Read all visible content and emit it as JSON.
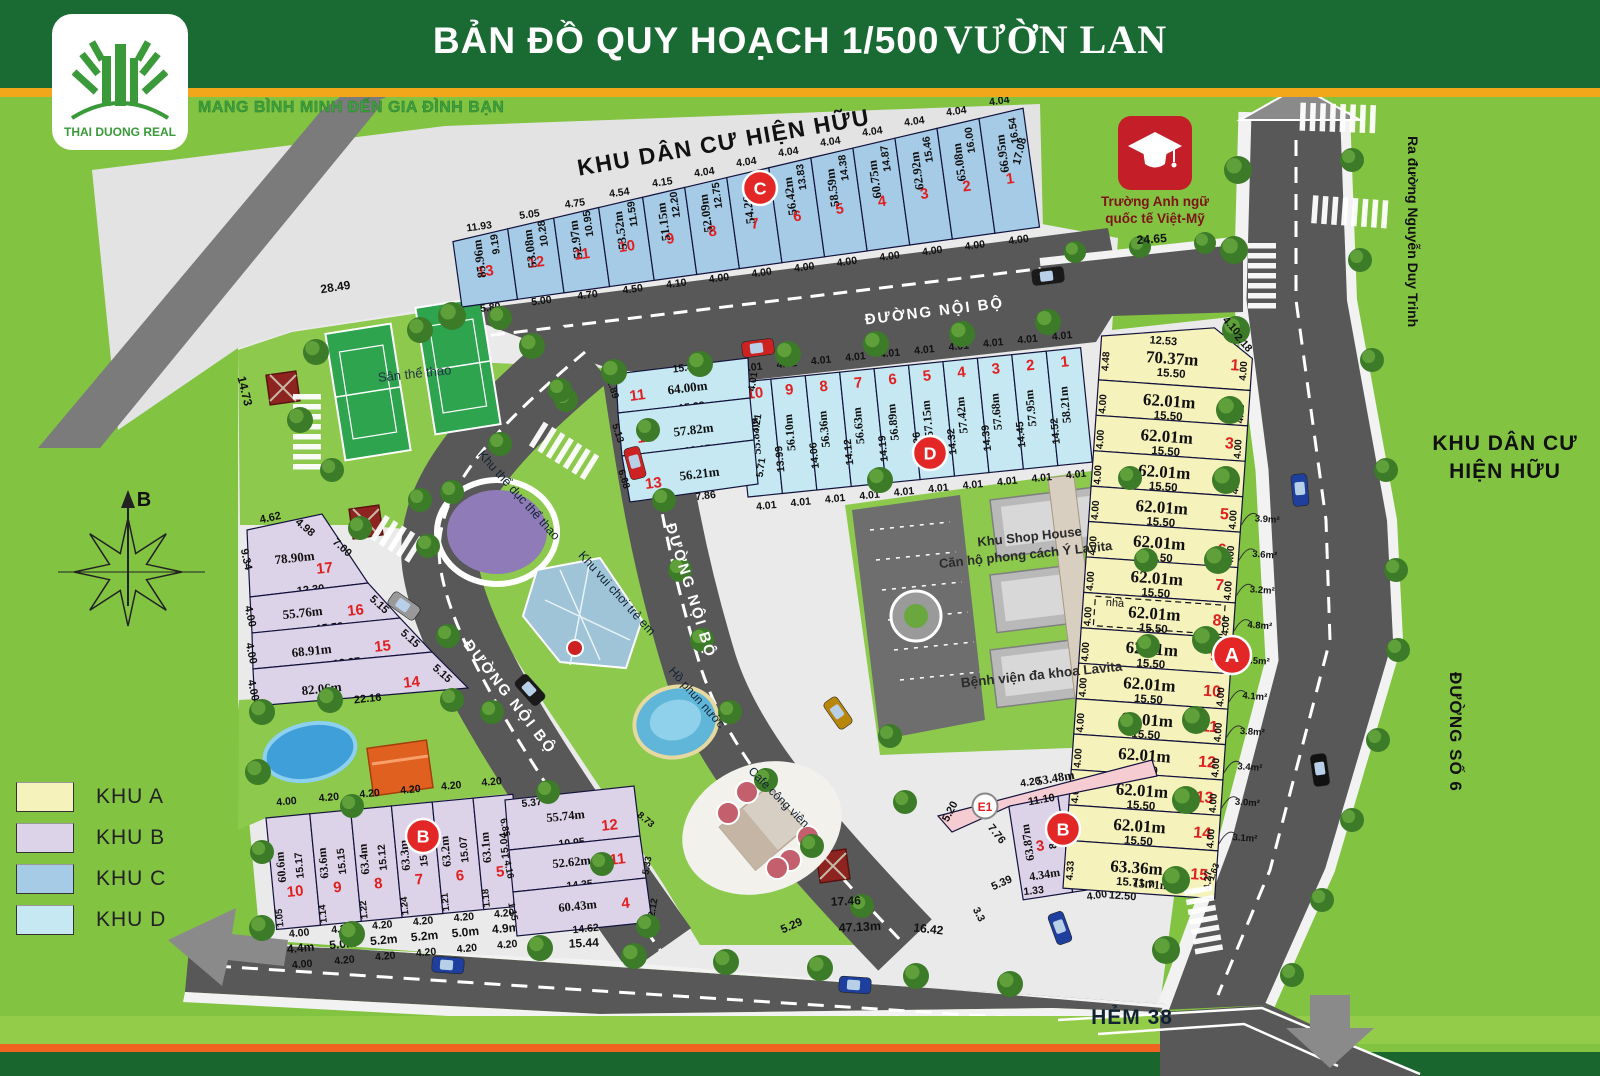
{
  "header": {
    "title_main": "BẢN ĐỒ QUY HOẠCH 1/500",
    "title_name": "VƯỜN LAN",
    "logo_text": "THAI DUONG REAL",
    "slogan": "MANG BÌNH MINH ĐẾN GIA ĐÌNH BẠN"
  },
  "legend": {
    "items": [
      {
        "label": "KHU A",
        "color": "#f5f2bb"
      },
      {
        "label": "KHU B",
        "color": "#ddd3e9"
      },
      {
        "label": "KHU C",
        "color": "#a6cbe7"
      },
      {
        "label": "KHU D",
        "color": "#c5e8f3"
      }
    ]
  },
  "labels": {
    "existing_top": "KHU DÂN CƯ HIỆN HỮU",
    "existing_right1": "KHU DÂN CƯ",
    "existing_right2": "HIỆN HỮU",
    "internal_road": "ĐƯỜNG NỘI BỘ",
    "road_exit": "Ra đường Nguyễn Duy Trinh",
    "road_6": "ĐƯỜNG SỐ 6",
    "alley": "HẺM 38",
    "school1": "Trường Anh ngữ",
    "school2": "quốc tế Việt-Mỹ",
    "sports_field": "Sân thể thao",
    "gym_area": "Khu thể dục thể thao",
    "playground": "Khu vui chơi trẻ em",
    "fountain": "Hồ phun nước",
    "cafe": "Cafe công viên",
    "shophouse1": "Khu Shop House",
    "shophouse2": "Căn hộ phong cách Ý Lavita",
    "hospital": "Bệnh viện đa khoa Lavita",
    "compass_north": "B",
    "house_note": "nhà"
  },
  "markers": {
    "A": "A",
    "B": "B",
    "C": "C",
    "D": "D",
    "E": "E1"
  },
  "zones": {
    "C": {
      "lots": [
        {
          "n": "13",
          "len": "85.96m",
          "side": "9.19",
          "top": "11.93",
          "bot": "5.80"
        },
        {
          "n": "12",
          "len": "53.08m",
          "side": "10.28",
          "top": "5.05",
          "bot": "5.00"
        },
        {
          "n": "11",
          "len": "52.97m",
          "side": "10.95",
          "top": "4.75",
          "bot": "4.70"
        },
        {
          "n": "10",
          "len": "53.52m",
          "side": "11.59",
          "top": "4.54",
          "bot": "4.50"
        },
        {
          "n": "9",
          "len": "51.15m",
          "side": "12.20",
          "top": "4.15",
          "bot": "4.10"
        },
        {
          "n": "8",
          "len": "52.09m",
          "side": "12.75",
          "top": "4.04",
          "bot": "4.00"
        },
        {
          "n": "7",
          "len": "54.26m",
          "side": "13.29",
          "top": "4.04",
          "bot": "4.00"
        },
        {
          "n": "6",
          "len": "56.42m",
          "side": "13.83",
          "top": "4.04",
          "bot": "4.00"
        },
        {
          "n": "5",
          "len": "58.59m",
          "side": "14.38",
          "top": "4.04",
          "bot": "4.00"
        },
        {
          "n": "4",
          "len": "60.75m",
          "side": "14.87",
          "top": "4.04",
          "bot": "4.00"
        },
        {
          "n": "3",
          "len": "62.92m",
          "side": "15.46",
          "top": "4.04",
          "bot": "4.00"
        },
        {
          "n": "2",
          "len": "65.08m",
          "side": "16.00",
          "top": "4.04",
          "bot": "4.00"
        },
        {
          "n": "1",
          "len": "66.95m",
          "side": "16.54",
          "top": "4.04",
          "bot": "4.00"
        }
      ]
    },
    "D": {
      "lots": [
        {
          "n": "10",
          "len": "55.83m",
          "side": "",
          "top": "4.01",
          "bot": "4.01"
        },
        {
          "n": "9",
          "len": "56.10m",
          "side": "13.99",
          "top": "4.01",
          "bot": "4.01"
        },
        {
          "n": "8",
          "len": "56.36m",
          "side": "14.06",
          "top": "4.01",
          "bot": "4.01"
        },
        {
          "n": "7",
          "len": "56.63m",
          "side": "14.12",
          "top": "4.01",
          "bot": "4.01"
        },
        {
          "n": "6",
          "len": "56.89m",
          "side": "14.19",
          "top": "4.01",
          "bot": "4.01"
        },
        {
          "n": "5",
          "len": "57.15m",
          "side": "14.26",
          "top": "4.01",
          "bot": "4.01"
        },
        {
          "n": "4",
          "len": "57.42m",
          "side": "14.32",
          "top": "4.01",
          "bot": "4.01"
        },
        {
          "n": "3",
          "len": "57.68m",
          "side": "14.39",
          "top": "4.01",
          "bot": "4.01"
        },
        {
          "n": "2",
          "len": "57.95m",
          "side": "14.45",
          "top": "4.01",
          "bot": "4.01"
        },
        {
          "n": "1",
          "len": "58.21m",
          "side": "14.52",
          "top": "4.01",
          "bot": "4.01"
        }
      ],
      "rows": [
        {
          "n": "11",
          "len": "64.00m",
          "top": "15.46",
          "bot": "15.38",
          "left": "1.89",
          "right": "4.01"
        },
        {
          "n": "12",
          "len": "57.82m",
          "top": "",
          "bot": "12.15",
          "left": "5.13",
          "right": "4.21"
        },
        {
          "n": "13",
          "len": "56.21m",
          "top": "",
          "bot": "7.86",
          "left": "6.68",
          "right": "5.71"
        }
      ]
    },
    "A": {
      "lots": [
        {
          "n": "1",
          "len": "70.37m",
          "sub": "15.50",
          "left": "4.48",
          "right": "4.00",
          "top": "12.53",
          "note": ""
        },
        {
          "n": "2",
          "len": "62.01m",
          "sub": "15.50",
          "left": "4.00",
          "right": "4.00",
          "note": ""
        },
        {
          "n": "3",
          "len": "62.01m",
          "sub": "15.50",
          "left": "4.00",
          "right": "4.00",
          "note": ""
        },
        {
          "n": "4",
          "len": "62.01m",
          "sub": "15.50",
          "left": "4.00",
          "right": "4.00",
          "note": ""
        },
        {
          "n": "5",
          "len": "62.01m",
          "sub": "15.50",
          "left": "4.00",
          "right": "4.00",
          "note": "3.9m²"
        },
        {
          "n": "6",
          "len": "62.01m",
          "sub": "15.50",
          "left": "4.00",
          "right": "4.00",
          "note": "3.6m²"
        },
        {
          "n": "7",
          "len": "62.01m",
          "sub": "15.50",
          "left": "4.00",
          "right": "4.00",
          "note": "3.2m²"
        },
        {
          "n": "8",
          "len": "62.01m",
          "sub": "15.50",
          "left": "4.00",
          "right": "4.00",
          "note": "4.8m²"
        },
        {
          "n": "9",
          "len": "62.01m",
          "sub": "15.50",
          "left": "4.00",
          "right": "4.00",
          "note": "4.5m²"
        },
        {
          "n": "10",
          "len": "62.01m",
          "sub": "15.50",
          "left": "4.00",
          "right": "4.00",
          "note": "4.1m²"
        },
        {
          "n": "11",
          "len": "62.01m",
          "sub": "15.50",
          "left": "4.00",
          "right": "4.00",
          "note": "3.8m²"
        },
        {
          "n": "12",
          "len": "62.01m",
          "sub": "15.50",
          "left": "4.00",
          "right": "4.00",
          "note": "3.4m²"
        },
        {
          "n": "13",
          "len": "62.01m",
          "sub": "15.50",
          "left": "4.00",
          "right": "4.00",
          "note": "3.0m²"
        },
        {
          "n": "14",
          "len": "62.01m",
          "sub": "15.50",
          "left": "4.00",
          "right": "4.00",
          "note": "3.1m²"
        },
        {
          "n": "15",
          "len": "63.36m",
          "sub": "15.71m",
          "bot2": "12.50",
          "left": "4.33",
          "right": "4.27",
          "right2": "1.63",
          "note": ""
        }
      ]
    },
    "B": {
      "cols": [
        {
          "n": "10",
          "len": "60.6m",
          "side": "15.17",
          "top": "4.00",
          "foot": "1.05",
          "bot": "4.00",
          "b2": "4.4m",
          "b3": "4.00"
        },
        {
          "n": "9",
          "len": "63.6m",
          "side": "15.15",
          "top": "4.20",
          "foot": "1.14",
          "bot": "4.20",
          "b2": "5.0m",
          "b3": "4.20"
        },
        {
          "n": "8",
          "len": "63.4m",
          "side": "15.12",
          "top": "4.20",
          "foot": "1.22",
          "bot": "4.20",
          "b2": "5.2m",
          "b3": "4.20"
        },
        {
          "n": "7",
          "len": "63.3m",
          "side": "15.09",
          "top": "4.20",
          "foot": "1.24",
          "bot": "4.20",
          "b2": "5.2m",
          "b3": "4.20"
        },
        {
          "n": "6",
          "len": "63.2m",
          "side": "15.07",
          "top": "4.20",
          "foot": "1.21",
          "bot": "4.20",
          "b2": "5.0m",
          "b3": "4.20"
        },
        {
          "n": "5",
          "len": "63.1m",
          "side": "15.04",
          "top": "4.20",
          "foot": "1.18",
          "bot": "4.20",
          "b2": "4.9m",
          "b3": "4.20"
        }
      ],
      "rows": [
        {
          "n": "12",
          "len": "55.74m",
          "top": "5.37",
          "bot": "10.95",
          "left": "6.85",
          "right": "8.73"
        },
        {
          "n": "11",
          "len": "52.62m",
          "top": "",
          "bot": "14.35",
          "left": "4.16",
          "right": "5.33"
        },
        {
          "n": "4",
          "len": "60.43m",
          "top": "",
          "bot": "14.62",
          "left": "1.15",
          "right": "2.12"
        }
      ],
      "upper": [
        {
          "n": "17",
          "len": "78.90m",
          "bot": "12.30"
        },
        {
          "n": "16",
          "len": "55.76m",
          "bot": "15.58"
        },
        {
          "n": "15",
          "len": "68.91m",
          "bot": "18.87"
        },
        {
          "n": "14",
          "len": "82.06m",
          "bot": "22.16"
        }
      ],
      "right": [
        {
          "n": "3",
          "len": "63.87m",
          "side": "8.86",
          "top": "4.20",
          "b2": "4.34m",
          "bot": ""
        },
        {
          "n": "2",
          "len": "52.52m",
          "side": "13.20",
          "top": "",
          "b2": "4.40m",
          "bot": "4.00"
        },
        {
          "n": "1",
          "len": "53.07m",
          "side": "4.33",
          "top": "",
          "b2": "4.30m",
          "bot": "4.00"
        }
      ]
    },
    "E1": {
      "len": "53.48m",
      "w": "11.10",
      "side": "5.20"
    }
  },
  "floating": [
    "28.49",
    "14.73",
    "17.08",
    "4.10",
    "2.18",
    "24.65",
    "15.44",
    "17.46",
    "5.29",
    "47.13m",
    "16.42",
    "3.3",
    "4.62",
    "4.98",
    "9.34",
    "4.00",
    "4.00",
    "4.00",
    "7.00",
    "5.15",
    "5.15",
    "5.15",
    "7.76",
    "5.39",
    "1.33"
  ]
}
